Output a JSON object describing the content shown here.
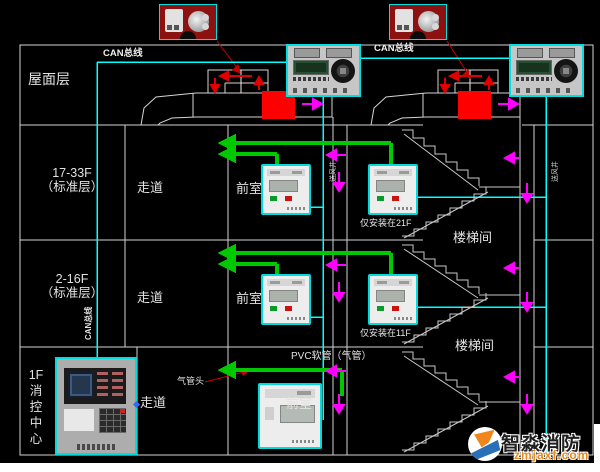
{
  "bus": {
    "left_label": "CAN总线",
    "right_label": "CAN总线",
    "vertical_label": "CAN总线"
  },
  "floors": {
    "roof": "屋面层",
    "f17_33": {
      "line1": "17-33F",
      "line2": "（标准层）"
    },
    "f2_16": {
      "line1": "2-16F",
      "line2": "（标准层）"
    },
    "f1": {
      "chars": [
        "1F",
        "消",
        "控",
        "中",
        "心"
      ]
    }
  },
  "rows": [
    {
      "corridor": "走道",
      "front_room": "前室",
      "note": "仅安装在21F"
    },
    {
      "corridor": "走道",
      "front_room": "前室",
      "note": "仅安装在11F"
    },
    {
      "corridor": "走道",
      "front_room": "前室"
    }
  ],
  "stairwell": {
    "label1": "楼梯间",
    "label2": "楼梯间"
  },
  "shafts": {
    "left_label": "送风井",
    "right_label": "送风井"
  },
  "pvc": {
    "pipe_label": "PVC软管（气管）",
    "head_label": "气管头"
  },
  "watermark": {
    "brand": "智淼消防",
    "domain": "zmjaxf.com"
  },
  "colors": {
    "can_bus": "#00FFFF",
    "air_tube": "#00C800",
    "fan": "#FF0000",
    "airflow_arrow": "#FF00FF",
    "wall": "#D4D4D4",
    "leader": "#C80000"
  }
}
